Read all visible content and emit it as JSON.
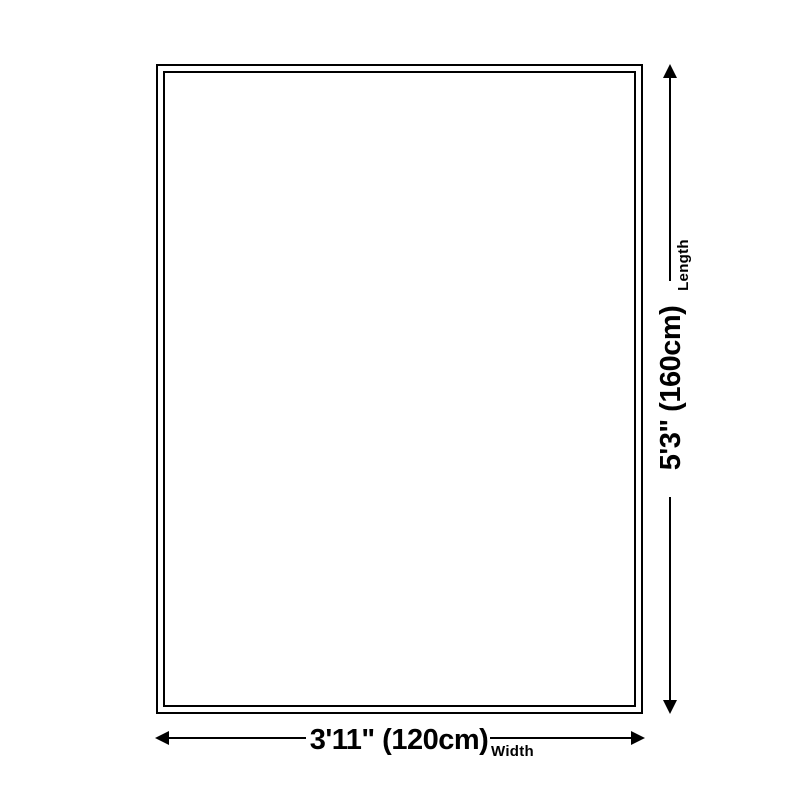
{
  "diagram": {
    "background_color": "#ffffff",
    "ink_color": "#000000",
    "length": {
      "label": "Length",
      "value": "5'3\" (160cm)"
    },
    "width": {
      "label": "Width",
      "value": "3'11\" (120cm)"
    }
  }
}
